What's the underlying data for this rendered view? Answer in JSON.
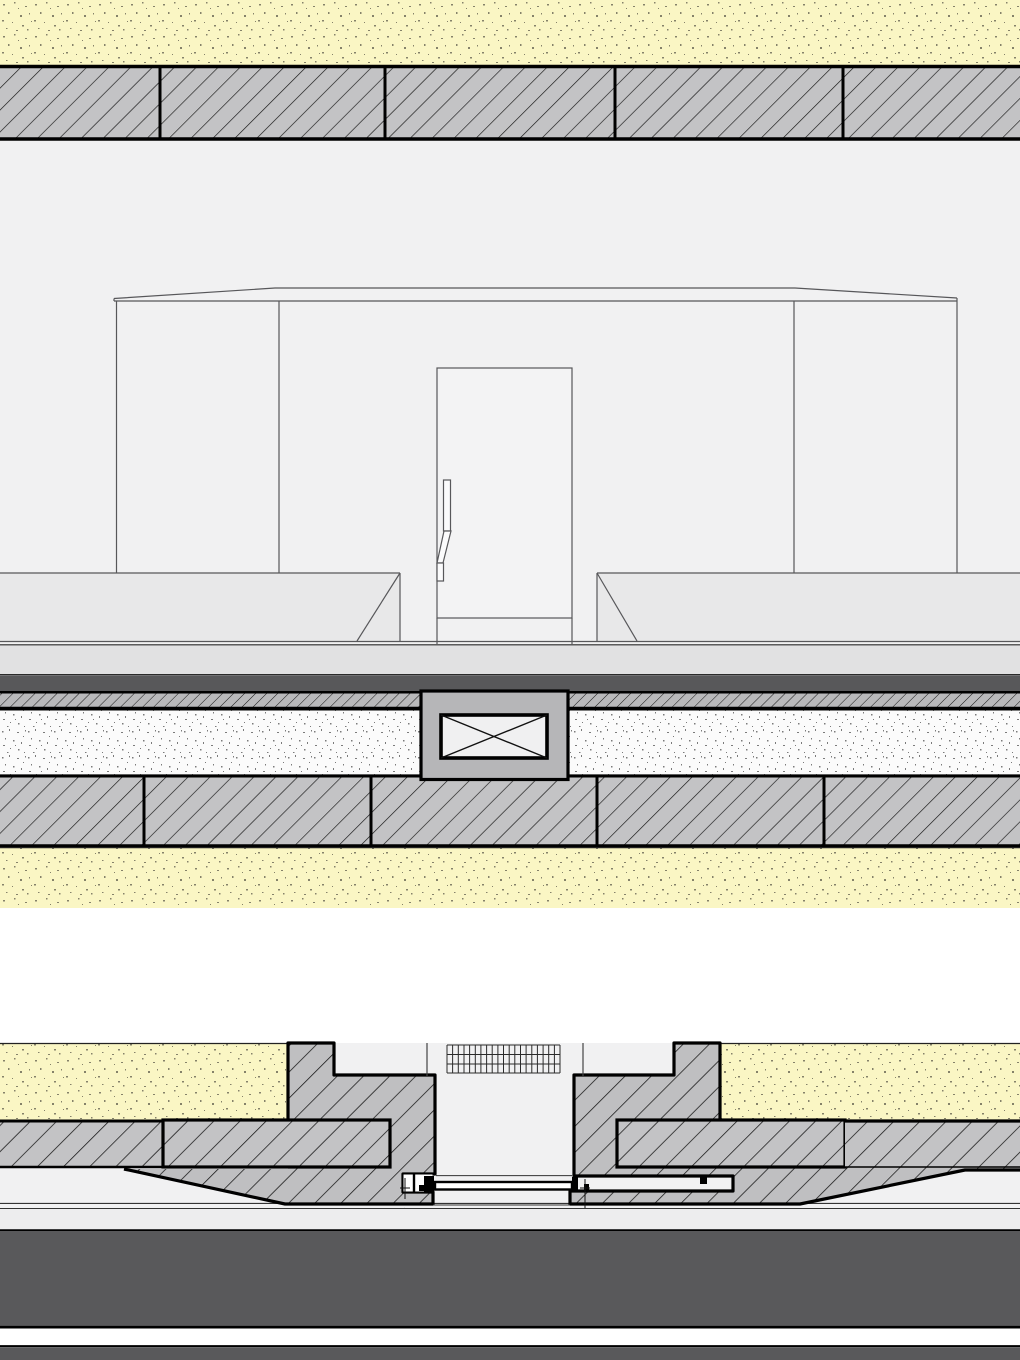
{
  "document": {
    "kind": "architectural-detail-drawing",
    "views": [
      {
        "id": "vertical-section-elevation",
        "parts": [
          "ceiling-insulation",
          "ceiling-masonry-band",
          "interior-elevation",
          "door",
          "door-handle",
          "bench-left",
          "bench-right",
          "floor-finish",
          "waterproofing-membrane",
          "separation-layer",
          "insulation-layer",
          "floor-masonry-band",
          "subsoil-insulation",
          "floor-duct-block",
          "duct-cross-symbol"
        ]
      },
      {
        "id": "plan-section-door-jambs",
        "parts": [
          "insulation-left",
          "insulation-right",
          "jamb-left",
          "jamb-right",
          "wall-band",
          "ventilation-grille",
          "door-leaf-plan",
          "pivot-left",
          "pivot-right",
          "screed-band",
          "structural-slab",
          "base-band"
        ]
      }
    ]
  },
  "colors": {
    "page_bg": "#ffffff",
    "drawing_bg": "#f1f1f2",
    "yellow_fill": "#faf6c4",
    "yellow_speckle": "#85826a",
    "masonry_fill": "#c3c3c5",
    "jamb_fill": "#bfbfc1",
    "fine_hatch_fill": "#b9b9bb",
    "stipple_fill": "#fbfbfb",
    "stipple_dot": "#7b7b7b",
    "dark_membrane": "#58585a",
    "dark_slab": "#59595b",
    "floor_band": "#e1e1e2",
    "screed_band": "#ededee",
    "bench_fill": "#e8e8e9",
    "door_fill": "#f3f3f4",
    "handle_fill": "#fbfbfc",
    "block_fill": "#b6b6b8",
    "xbox_fill": "#f0f0f1",
    "line_black": "#000000",
    "line_thin": "#57575a",
    "hatch_line": "#151515",
    "white": "#ffffff"
  }
}
